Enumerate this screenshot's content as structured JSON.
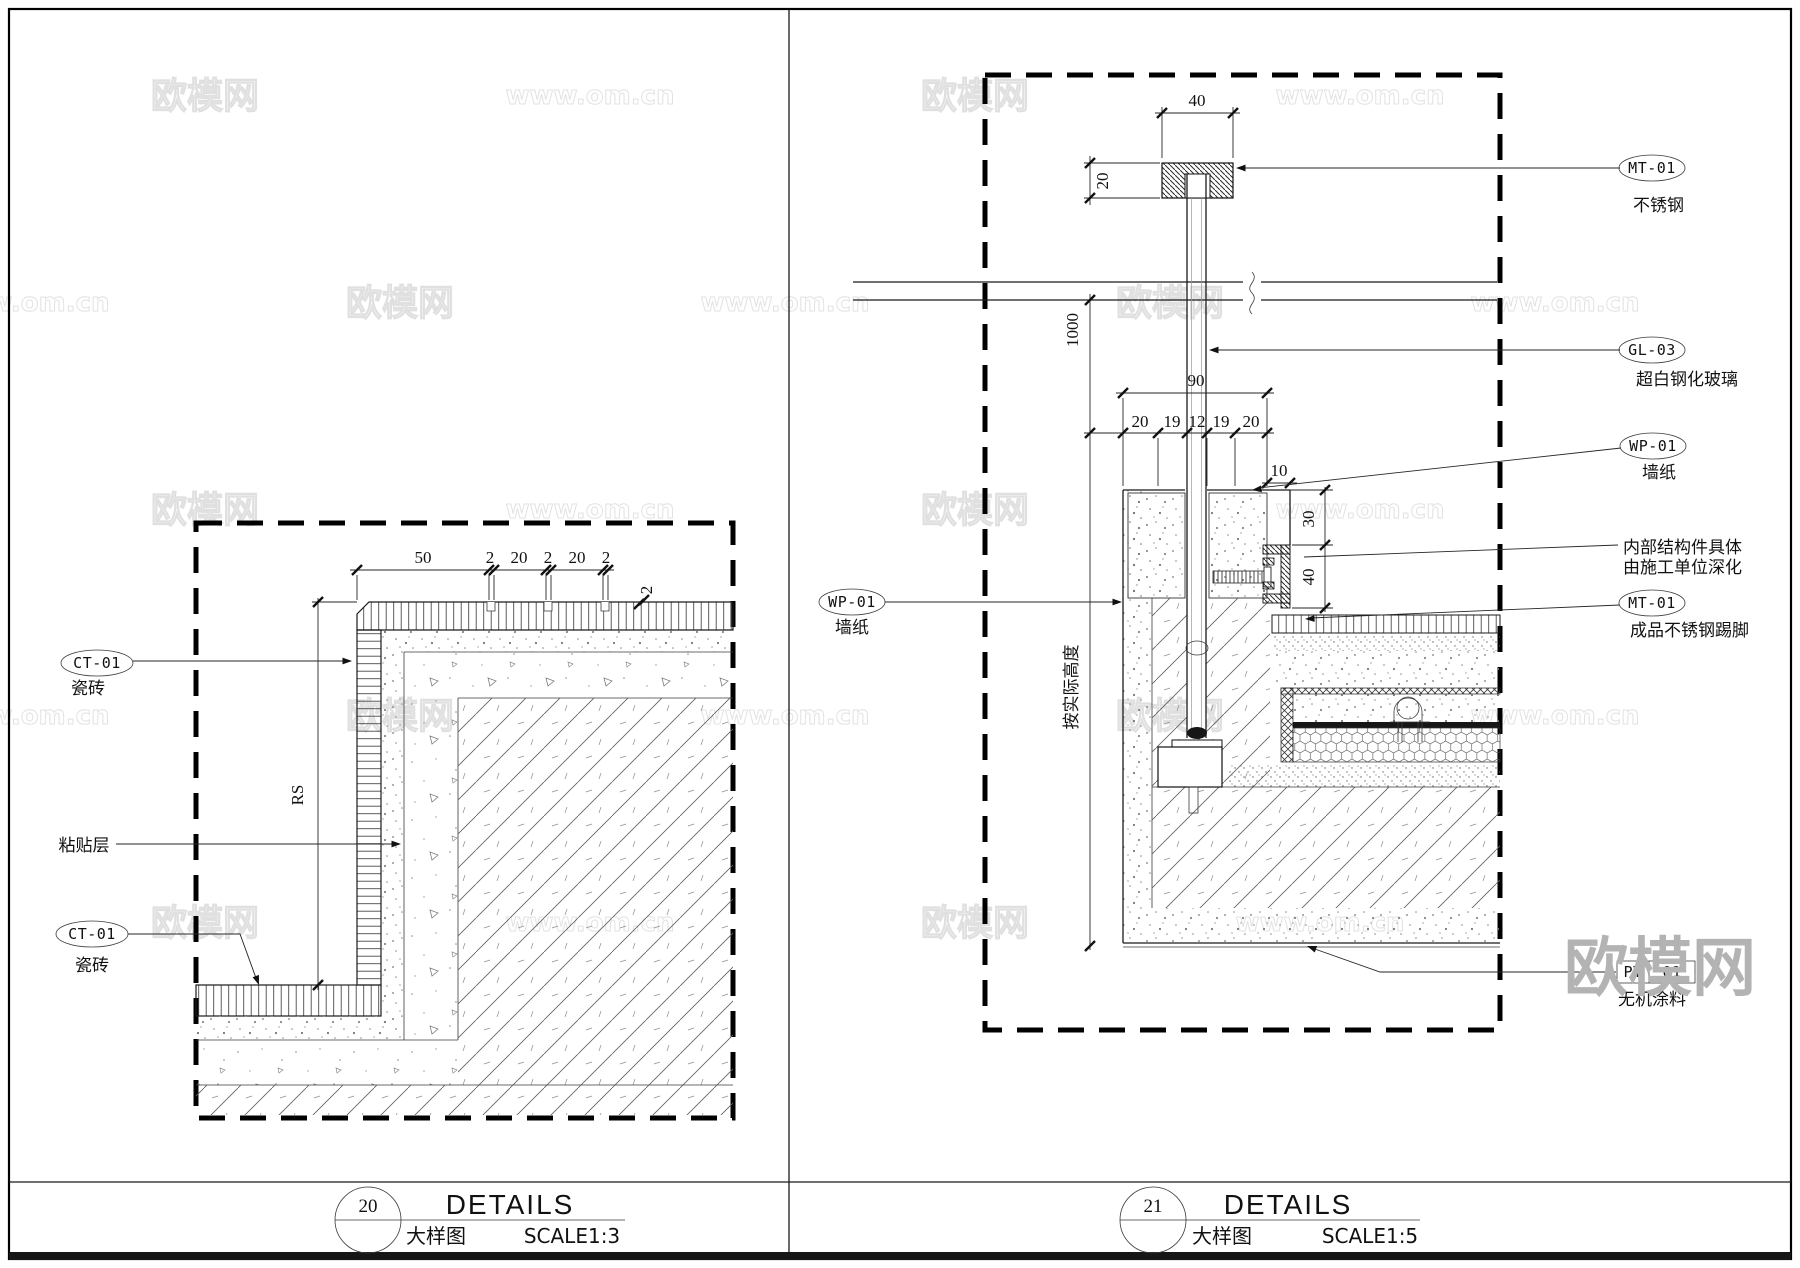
{
  "watermarks": {
    "brand": "欧模网",
    "site": "www.om.cn",
    "logo": "欧模网"
  },
  "left": {
    "callouts": {
      "tile_top_code": "CT-01",
      "tile_top_name": "瓷砖",
      "adhesive": "粘贴层",
      "tile_bottom_code": "CT-01",
      "tile_bottom_name": "瓷砖"
    },
    "dims": {
      "d50": "50",
      "g1": "2",
      "d20a": "20",
      "g2": "2",
      "d20b": "20",
      "g3": "2",
      "thk": "2",
      "rs": "RS"
    },
    "titleblock": {
      "num": "20",
      "title": "DETAILS",
      "sub": "大样图",
      "scale": "SCALE1:3"
    }
  },
  "right": {
    "callouts": {
      "mt_top_code": "MT-01",
      "mt_top_name": "不锈钢",
      "gl_code": "GL-03",
      "gl_name": "超白钢化玻璃",
      "wp_r_code": "WP-01",
      "wp_r_name": "墙纸",
      "note_line1": "内部结构件具体",
      "note_line2": "由施工单位深化",
      "mt_skirt_code": "MT-01",
      "mt_skirt_name": "成品不锈钢踢脚",
      "wp_l_code": "WP-01",
      "wp_l_name": "墙纸",
      "pt_code": "PT",
      "pt_num": "01",
      "pt_name": "无机涂料"
    },
    "dims": {
      "cap_w": "40",
      "cap_h": "20",
      "ceil": "1000",
      "pocket": "90",
      "c1": "20",
      "c2": "19",
      "c3": "12",
      "c4": "19",
      "c5": "20",
      "off": "10",
      "d30": "30",
      "d40": "40",
      "height_note": "按实际高度"
    },
    "titleblock": {
      "num": "21",
      "title": "DETAILS",
      "sub": "大样图",
      "scale": "SCALE1:5"
    }
  }
}
